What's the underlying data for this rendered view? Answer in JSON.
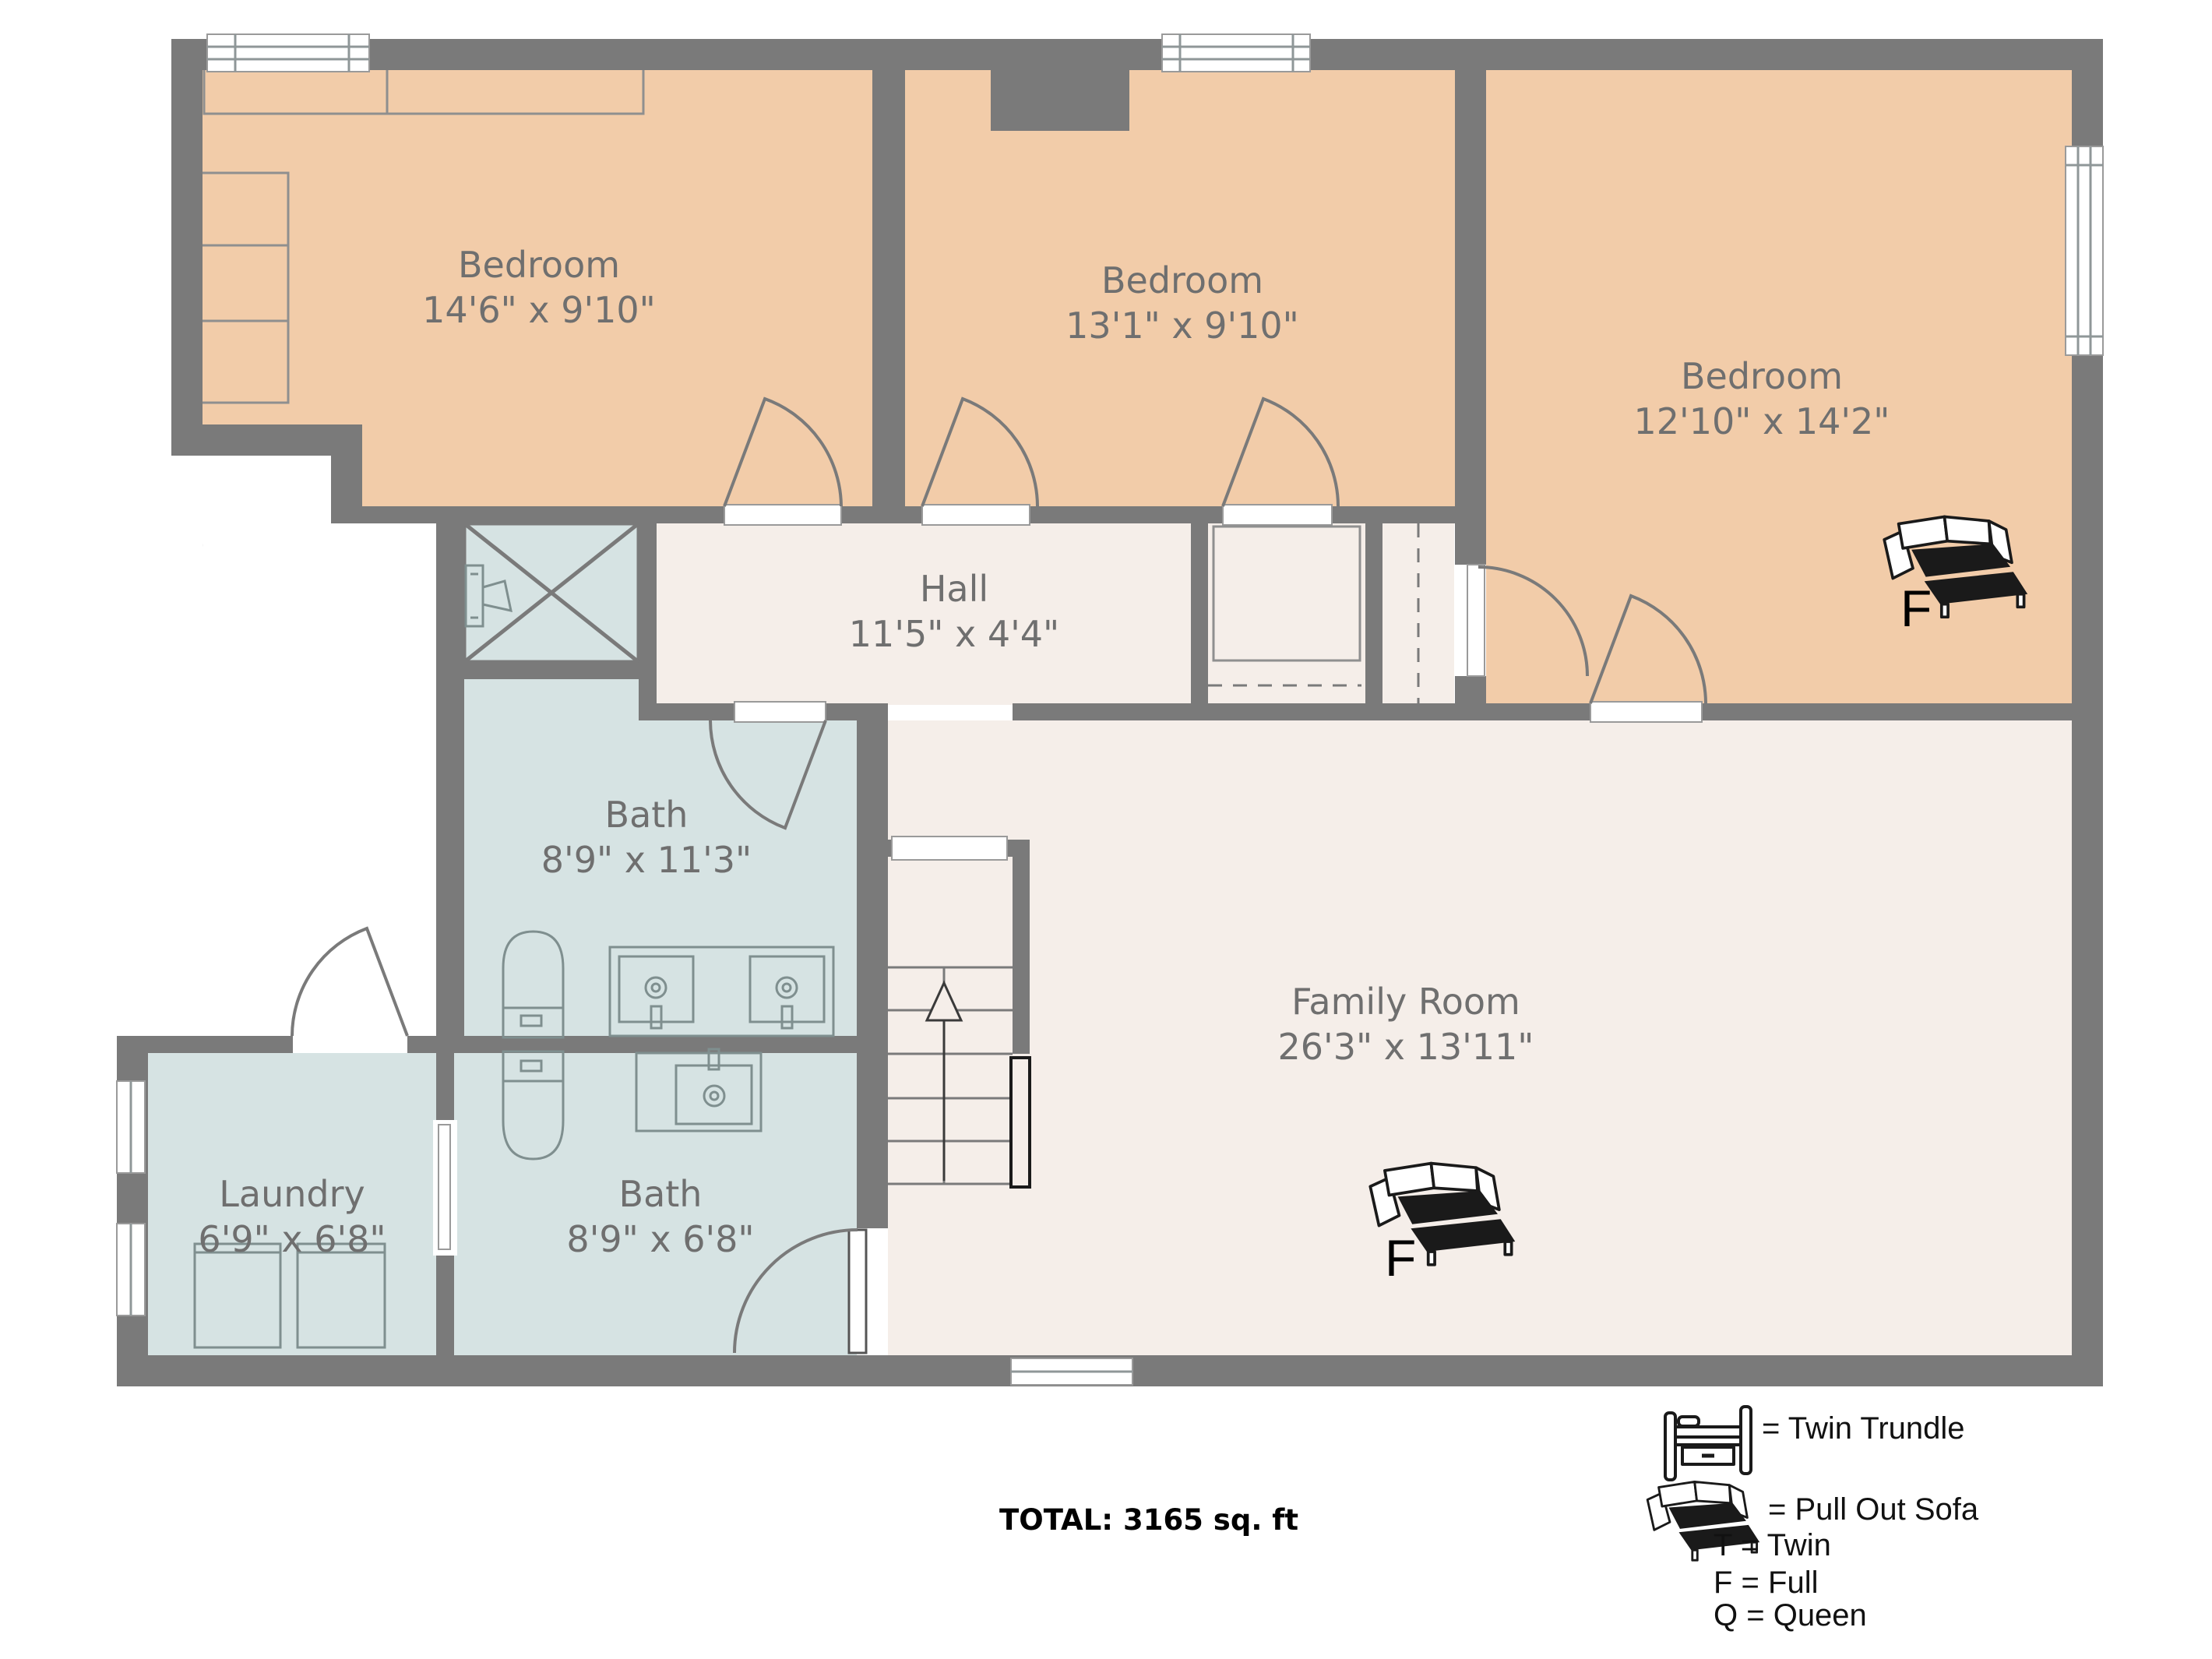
{
  "rooms": [
    {
      "name": "Bedroom",
      "dims": "14'6\" x 9'10\""
    },
    {
      "name": "Bedroom",
      "dims": "13'1\" x 9'10\""
    },
    {
      "name": "Bedroom",
      "dims": "12'10\" x 14'2\""
    },
    {
      "name": "Hall",
      "dims": "11'5\" x 4'4\""
    },
    {
      "name": "Bath",
      "dims": "8'9\" x 11'3\""
    },
    {
      "name": "Laundry",
      "dims": "6'9\" x 6'8\""
    },
    {
      "name": "Bath",
      "dims": "8'9\" x 6'8\""
    },
    {
      "name": "Family Room",
      "dims": "26'3\" x 13'11\""
    }
  ],
  "sofa_labels": {
    "bedroom": "F",
    "family_room": "F"
  },
  "legend": {
    "twin_trundle": "= Twin Trundle",
    "pull_out_sofa": "= Pull Out Sofa",
    "abbreviations": [
      "T = Twin",
      "F = Full",
      "Q = Queen"
    ]
  },
  "total": "TOTAL: 3165 sq. ft",
  "colors": {
    "bedroom_fill": "#f2cca9",
    "common_fill": "#f5eee9",
    "bath_fill": "#d6e3e3",
    "wall": "#7a7a7a",
    "label_text": "#6f6f6f",
    "legend_text": "#111111"
  }
}
